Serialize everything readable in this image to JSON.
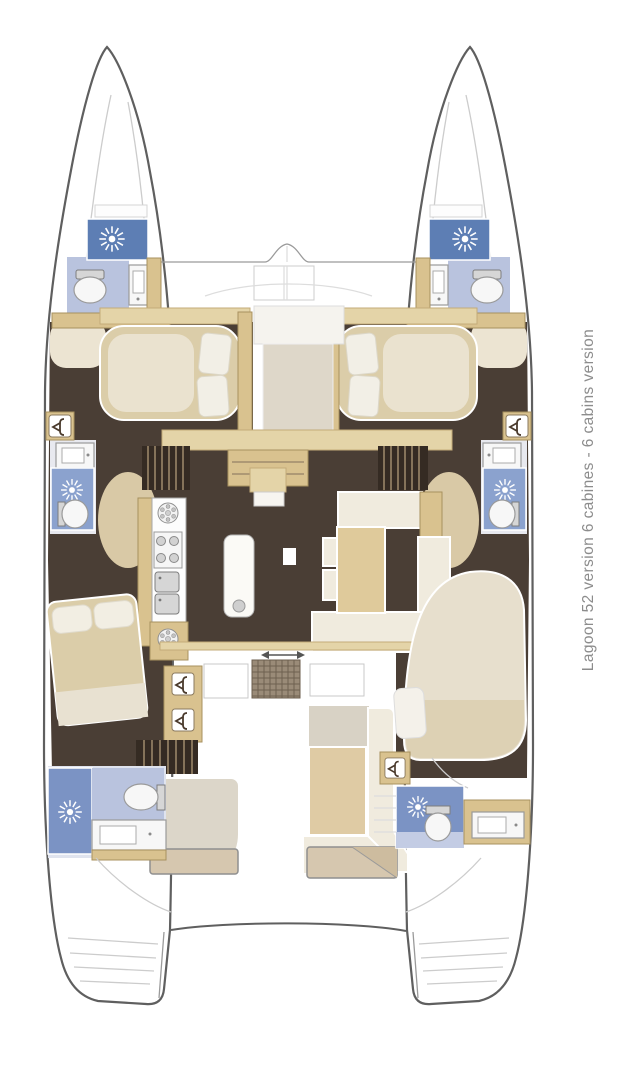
{
  "caption": {
    "text": "Lagoon 52 version 6 cabines - 6 cabins version"
  },
  "palette": {
    "outline": "#5f5f5f",
    "deck_line": "#cccccc",
    "floor_dark": "#4a3e35",
    "wood": "#d9c28f",
    "wood_light": "#e4d4a8",
    "cream": "#f0ebde",
    "beige": "#dbcda9",
    "sunpad": "#d6c7af",
    "shower_blue": "#5d7eb4",
    "shower_blue_mid": "#8ba2ce",
    "shower_blue_aft": "#7b93c4",
    "bath_floor_blue": "#b9c3de",
    "fixture_gray": "#d6d6d6",
    "mat_brown": "#9a8b78",
    "stairs_dark": "#352b23",
    "caption_gray": "#8c8c8c",
    "white": "#ffffff"
  },
  "plan": {
    "type": "yacht-deck-plan",
    "vessel": "catamaran",
    "cabins_shown": 6,
    "heads_shown": 6,
    "icons": {
      "shower": "sun-burst-icon",
      "wardrobe": "hanger-icon",
      "stove": "four-burner-icon",
      "round_fixture": "round-hatch-icon",
      "toilet": "toilet-bowl-shape",
      "sink": "basin-rectangle"
    },
    "areas": [
      "bow-trampoline",
      "port-forward-head",
      "starboard-forward-head",
      "port-forward-cabin",
      "starboard-forward-cabin",
      "port-midship-head",
      "starboard-midship-head",
      "galley",
      "salon-dinette",
      "companionway-stairs",
      "cockpit",
      "port-aft-cabin",
      "starboard-aft-cabin",
      "port-aft-head",
      "starboard-aft-head",
      "aft-sunpads",
      "transom-steps"
    ]
  }
}
